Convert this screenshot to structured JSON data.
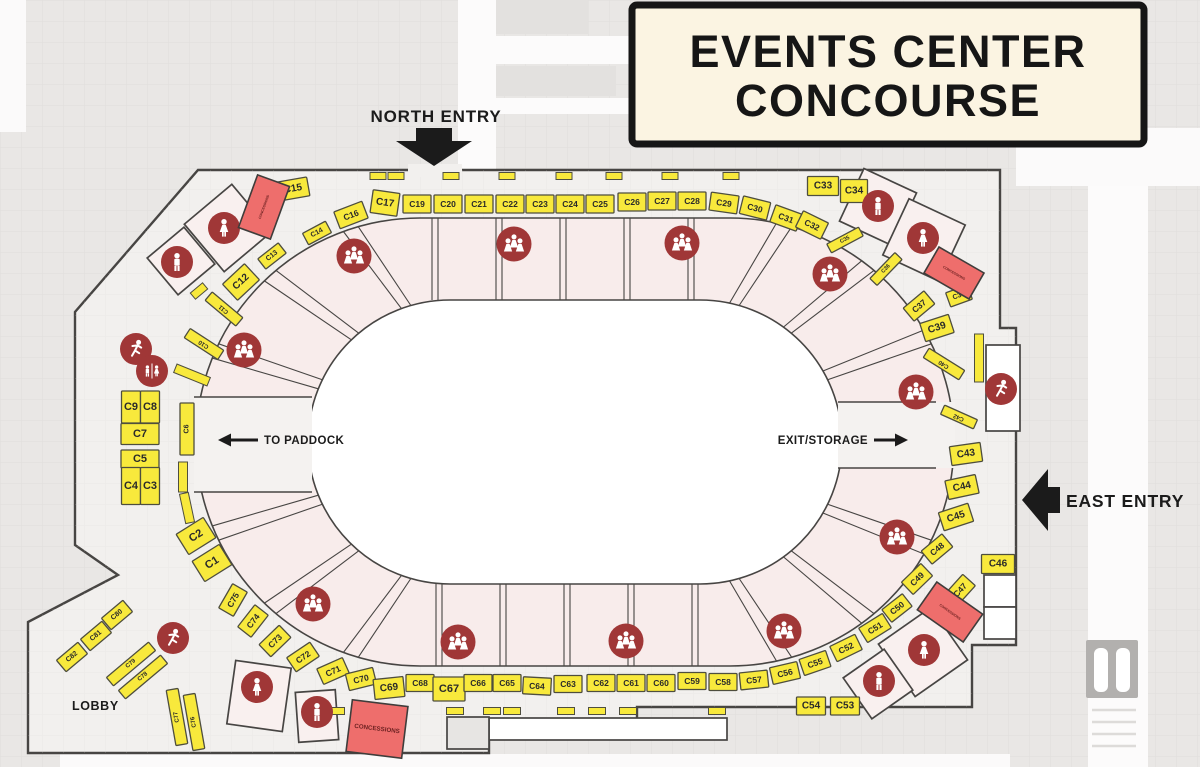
{
  "title": {
    "line1": "EVENTS CENTER",
    "line2": "CONCOURSE"
  },
  "labels": {
    "north_entry": "NORTH ENTRY",
    "east_entry": "EAST ENTRY",
    "to_paddock": "TO PADDOCK",
    "exit_storage": "EXIT/STORAGE",
    "lobby": "LOBBY",
    "concessions": "CONCESSIONS"
  },
  "colors": {
    "bg": "#e9e7e5",
    "grid": "#dcdad8",
    "floor": "#f2f0ee",
    "wall": "#474543",
    "field": "#ffffff",
    "ring": "#f8eceb",
    "room": "#f9f0ef",
    "booth": "#f8e93c",
    "booth_border": "#4e4e3e",
    "red": "#a03737",
    "concession": "#ee6e6c",
    "concession_border": "#3f3d3b",
    "title_bg": "#fbf4e2",
    "ink": "#1b1b1b"
  },
  "ring": {
    "top_xs": [
      432,
      438,
      496,
      502,
      560,
      566,
      624,
      630,
      688,
      694
    ],
    "bottom_xs": [
      436,
      442,
      500,
      506,
      564,
      570,
      628,
      634,
      692,
      698
    ],
    "left_angles": [
      106,
      110,
      130,
      134,
      154,
      158,
      202,
      206,
      226,
      230,
      250,
      254
    ],
    "right_angles": [
      74,
      78,
      50,
      54,
      26,
      30,
      -26,
      -30,
      -50,
      -54,
      -74,
      -78
    ]
  },
  "booths": [
    [
      "C19",
      417,
      204,
      28,
      18,
      0,
      0,
      0
    ],
    [
      "C20",
      448,
      204,
      28,
      18,
      0,
      0,
      0
    ],
    [
      "C21",
      479,
      204,
      28,
      18,
      0,
      0,
      0
    ],
    [
      "C22",
      510,
      204,
      28,
      18,
      0,
      0,
      0
    ],
    [
      "C23",
      540,
      204,
      28,
      18,
      0,
      0,
      0
    ],
    [
      "C24",
      570,
      204,
      28,
      18,
      0,
      0,
      0
    ],
    [
      "C25",
      600,
      204,
      28,
      18,
      0,
      0,
      0
    ],
    [
      "C26",
      632,
      202,
      28,
      18,
      0,
      0,
      0
    ],
    [
      "C27",
      662,
      201,
      28,
      18,
      0,
      0,
      0
    ],
    [
      "C28",
      692,
      201,
      28,
      18,
      0,
      0,
      0
    ],
    [
      "C29",
      724,
      203,
      28,
      18,
      8,
      0,
      0
    ],
    [
      "C30",
      755,
      208,
      28,
      18,
      14,
      0,
      0
    ],
    [
      "C31",
      786,
      218,
      28,
      18,
      20,
      0,
      0
    ],
    [
      "C32",
      812,
      225,
      28,
      18,
      26,
      0,
      0
    ],
    [
      "C33",
      823,
      186,
      31,
      19,
      0,
      10,
      0
    ],
    [
      "C34",
      854,
      191,
      27,
      23,
      0,
      10,
      0
    ],
    [
      "C17",
      385,
      203,
      27,
      23,
      8,
      10,
      0
    ],
    [
      "C16",
      351,
      215,
      30,
      18,
      -21,
      0,
      0
    ],
    [
      "C15",
      293,
      189,
      31,
      19,
      -10,
      10,
      0
    ],
    [
      "C14",
      317,
      233,
      26,
      13,
      -28,
      7,
      0
    ],
    [
      "C13",
      272,
      256,
      26,
      13,
      -38,
      7,
      0
    ],
    [
      "C12",
      241,
      282,
      30,
      22,
      -43,
      10,
      0
    ],
    [
      "C11",
      224,
      309,
      11,
      40,
      -50,
      6,
      1
    ],
    [
      "C10",
      204,
      344,
      11,
      40,
      -57,
      6,
      1
    ],
    [
      "C6",
      187,
      429,
      14,
      52,
      0,
      7,
      1
    ],
    [
      "C9",
      131,
      407,
      19,
      32,
      0,
      11,
      0
    ],
    [
      "C8",
      150,
      407,
      19,
      32,
      0,
      11,
      0
    ],
    [
      "C7",
      140,
      434,
      38,
      21,
      0,
      11,
      0
    ],
    [
      "C5",
      140,
      459,
      38,
      18,
      0,
      11,
      0
    ],
    [
      "C4",
      131,
      486,
      19,
      37,
      0,
      11,
      0
    ],
    [
      "C3",
      150,
      486,
      19,
      37,
      0,
      11,
      0
    ],
    [
      "C2",
      196,
      536,
      32,
      24,
      -32,
      11,
      0
    ],
    [
      "C1",
      212,
      563,
      32,
      24,
      -32,
      11,
      0
    ],
    [
      "C75",
      233,
      600,
      28,
      17,
      -60,
      0,
      0
    ],
    [
      "C74",
      253,
      621,
      28,
      17,
      -52,
      0,
      0
    ],
    [
      "C73",
      275,
      641,
      28,
      17,
      -44,
      0,
      0
    ],
    [
      "C72",
      303,
      657,
      28,
      17,
      -34,
      0,
      0
    ],
    [
      "C71",
      333,
      671,
      28,
      17,
      -24,
      0,
      0
    ],
    [
      "C70",
      361,
      679,
      28,
      17,
      -14,
      0,
      0
    ],
    [
      "C69",
      389,
      688,
      30,
      20,
      -6,
      10,
      0
    ],
    [
      "C68",
      420,
      683,
      28,
      17,
      0,
      0,
      0
    ],
    [
      "C67",
      449,
      689,
      32,
      24,
      0,
      11,
      0
    ],
    [
      "C66",
      478,
      683,
      28,
      17,
      0,
      0,
      0
    ],
    [
      "C65",
      507,
      683,
      28,
      17,
      0,
      0,
      0
    ],
    [
      "C64",
      537,
      686,
      28,
      17,
      3,
      0,
      0
    ],
    [
      "C63",
      568,
      684,
      28,
      17,
      0,
      0,
      0
    ],
    [
      "C62",
      601,
      683,
      28,
      17,
      0,
      0,
      0
    ],
    [
      "C61",
      631,
      683,
      28,
      17,
      0,
      0,
      0
    ],
    [
      "C60",
      661,
      683,
      28,
      17,
      0,
      0,
      0
    ],
    [
      "C59",
      692,
      681,
      28,
      17,
      0,
      0,
      0
    ],
    [
      "C58",
      723,
      682,
      28,
      17,
      0,
      0,
      0
    ],
    [
      "C57",
      754,
      680,
      28,
      17,
      -6,
      0,
      0
    ],
    [
      "C56",
      785,
      673,
      28,
      17,
      -13,
      0,
      0
    ],
    [
      "C55",
      815,
      663,
      28,
      17,
      -19,
      0,
      0
    ],
    [
      "C52",
      846,
      648,
      28,
      17,
      -26,
      0,
      0
    ],
    [
      "C51",
      875,
      628,
      28,
      17,
      -32,
      0,
      0
    ],
    [
      "C50",
      897,
      608,
      26,
      16,
      -38,
      0,
      0
    ],
    [
      "C54",
      811,
      706,
      29,
      18,
      0,
      10,
      0
    ],
    [
      "C53",
      845,
      706,
      29,
      18,
      0,
      10,
      0
    ],
    [
      "C35",
      845,
      240,
      36,
      10,
      -28,
      5.5,
      0
    ],
    [
      "C36",
      886,
      269,
      36,
      10,
      -46,
      5.5,
      0
    ],
    [
      "C37",
      919,
      306,
      27,
      17,
      -40,
      0,
      0
    ],
    [
      "C38",
      959,
      296,
      23,
      15,
      -20,
      7,
      0
    ],
    [
      "C39",
      937,
      328,
      30,
      19,
      -18,
      10,
      0
    ],
    [
      "C40",
      944,
      364,
      11,
      42,
      -58,
      6,
      1
    ],
    [
      "C42",
      959,
      417,
      10,
      36,
      -66,
      6,
      1
    ],
    [
      "C43",
      966,
      454,
      31,
      19,
      -8,
      10,
      0
    ],
    [
      "C44",
      962,
      487,
      31,
      19,
      -12,
      10,
      0
    ],
    [
      "C45",
      956,
      517,
      31,
      19,
      -18,
      10,
      0
    ],
    [
      "C48",
      937,
      549,
      27,
      17,
      -40,
      0,
      0
    ],
    [
      "C49",
      917,
      579,
      27,
      17,
      -44,
      0,
      0
    ],
    [
      "C47",
      960,
      590,
      27,
      17,
      -48,
      0,
      0
    ],
    [
      "C46",
      998,
      564,
      33,
      19,
      0,
      10,
      0
    ],
    [
      "C82",
      72,
      657,
      28,
      15,
      -40,
      7,
      0
    ],
    [
      "C81",
      96,
      636,
      28,
      15,
      -40,
      7,
      0
    ],
    [
      "C80",
      117,
      615,
      28,
      15,
      -40,
      7,
      0
    ],
    [
      "C79",
      131,
      664,
      55,
      11,
      -40,
      6,
      0
    ],
    [
      "C78",
      143,
      677,
      55,
      11,
      -40,
      6,
      0
    ],
    [
      "C77",
      177,
      717,
      12,
      56,
      -10,
      6,
      1
    ],
    [
      "C76",
      194,
      722,
      12,
      56,
      -10,
      6,
      1
    ]
  ],
  "strips": [
    [
      192,
      375,
      9,
      36,
      -68
    ],
    [
      183,
      477,
      9,
      30,
      0
    ],
    [
      187,
      508,
      9,
      30,
      -12
    ],
    [
      199,
      291,
      16,
      8,
      -40
    ],
    [
      979,
      358,
      9,
      48,
      0
    ],
    [
      378,
      176,
      16,
      7,
      0
    ],
    [
      396,
      176,
      16,
      7,
      0
    ],
    [
      451,
      176,
      16,
      7,
      0
    ],
    [
      507,
      176,
      16,
      7,
      0
    ],
    [
      564,
      176,
      16,
      7,
      0
    ],
    [
      614,
      176,
      16,
      7,
      0
    ],
    [
      670,
      176,
      16,
      7,
      0
    ],
    [
      731,
      176,
      16,
      7,
      0
    ],
    [
      336,
      711,
      17,
      7,
      0
    ],
    [
      389,
      711,
      17,
      7,
      0
    ],
    [
      455,
      711,
      17,
      7,
      0
    ],
    [
      492,
      711,
      17,
      7,
      0
    ],
    [
      512,
      711,
      17,
      7,
      0
    ],
    [
      566,
      711,
      17,
      7,
      0
    ],
    [
      597,
      711,
      17,
      7,
      0
    ],
    [
      628,
      711,
      17,
      7,
      0
    ],
    [
      717,
      711,
      17,
      7,
      0
    ]
  ],
  "rooms": [
    [
      228,
      228,
      62,
      62,
      -40,
      ""
    ],
    [
      181,
      261,
      48,
      48,
      -40,
      ""
    ],
    [
      878,
      207,
      58,
      58,
      25,
      ""
    ],
    [
      924,
      240,
      62,
      62,
      25,
      ""
    ],
    [
      1003,
      388,
      34,
      86,
      0,
      "#ffffff"
    ],
    [
      923,
      652,
      64,
      64,
      -35,
      ""
    ],
    [
      878,
      684,
      50,
      50,
      -35,
      ""
    ],
    [
      259,
      696,
      56,
      64,
      8,
      ""
    ],
    [
      317,
      716,
      40,
      50,
      -4,
      ""
    ],
    [
      1000,
      591,
      32,
      32,
      0,
      "#ffffff"
    ],
    [
      1000,
      623,
      32,
      32,
      0,
      "#ffffff"
    ],
    [
      608,
      729,
      238,
      22,
      0,
      "#ffffff"
    ],
    [
      468,
      733,
      42,
      32,
      0,
      "#e7e5e3"
    ]
  ],
  "icons": [
    [
      "woman",
      224,
      228
    ],
    [
      "man",
      177,
      262
    ],
    [
      "man",
      878,
      206
    ],
    [
      "woman",
      923,
      238
    ],
    [
      "runner",
      136,
      349
    ],
    [
      "wc",
      152,
      371
    ],
    [
      "runner",
      1001,
      389
    ],
    [
      "runner",
      173,
      638
    ],
    [
      "woman",
      257,
      687
    ],
    [
      "man",
      317,
      712
    ],
    [
      "woman",
      924,
      650
    ],
    [
      "man",
      879,
      681
    ],
    [
      "group",
      354,
      256
    ],
    [
      "group",
      514,
      244
    ],
    [
      "group",
      682,
      243
    ],
    [
      "group",
      830,
      274
    ],
    [
      "group",
      244,
      350
    ],
    [
      "group",
      916,
      392
    ],
    [
      "group",
      897,
      537
    ],
    [
      "group",
      313,
      604
    ],
    [
      "group",
      458,
      642
    ],
    [
      "group",
      626,
      641
    ],
    [
      "group",
      784,
      631
    ]
  ],
  "concessions": [
    [
      264,
      207,
      34,
      56,
      20,
      0
    ],
    [
      954,
      273,
      52,
      30,
      30,
      0
    ],
    [
      950,
      612,
      56,
      34,
      35,
      0
    ],
    [
      377,
      729,
      56,
      52,
      7,
      1
    ]
  ]
}
